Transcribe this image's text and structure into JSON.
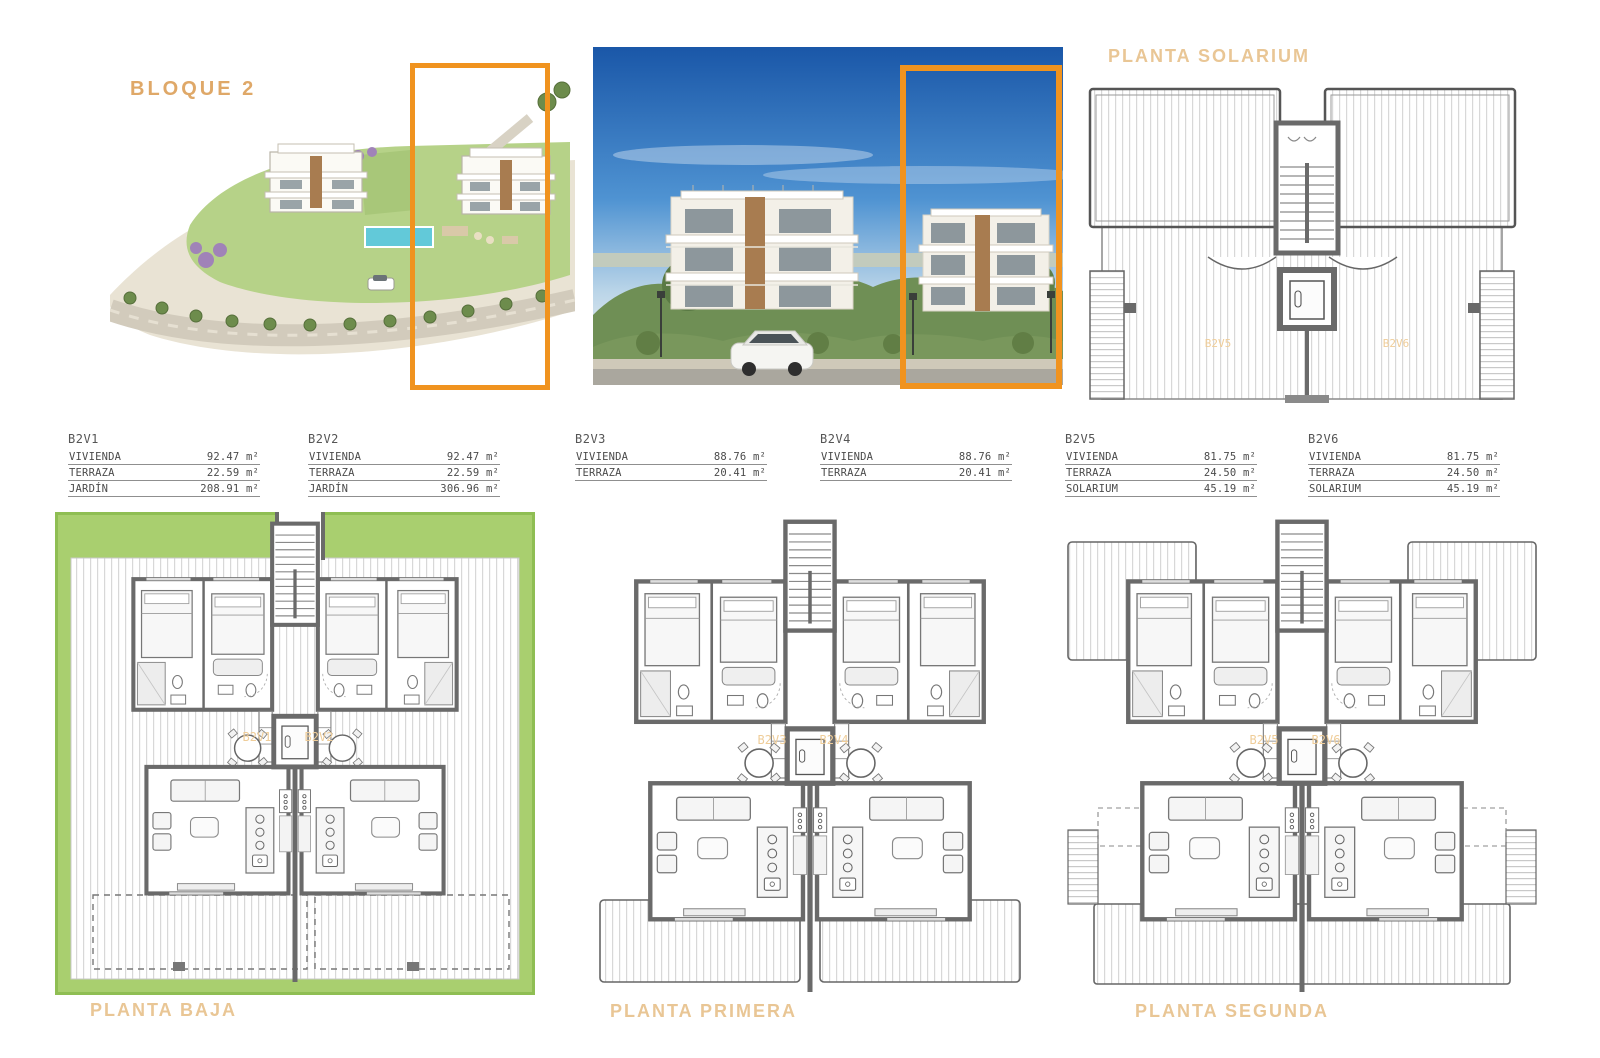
{
  "colors": {
    "accent_orange": "#F0931F",
    "label_tan": "#E9C695",
    "bloque_tan": "#DFA868",
    "garden_green": "#A9CF6F",
    "wall_gray": "#6A6A6A"
  },
  "header": {
    "bloque_label": "BLOQUE 2",
    "solarium_title": "PLANTA SOLARIUM"
  },
  "solarium_plan": {
    "unit_left": "B2V5",
    "unit_right": "B2V6"
  },
  "tables": [
    {
      "id": "B2V1",
      "rows": [
        {
          "label": "VIVIENDA",
          "value": "92.47 m²"
        },
        {
          "label": "TERRAZA",
          "value": "22.59 m²"
        },
        {
          "label": "JARDÍN",
          "value": "208.91 m²"
        }
      ]
    },
    {
      "id": "B2V2",
      "rows": [
        {
          "label": "VIVIENDA",
          "value": "92.47 m²"
        },
        {
          "label": "TERRAZA",
          "value": "22.59 m²"
        },
        {
          "label": "JARDÍN",
          "value": "306.96 m²"
        }
      ]
    },
    {
      "id": "B2V3",
      "rows": [
        {
          "label": "VIVIENDA",
          "value": "88.76 m²"
        },
        {
          "label": "TERRAZA",
          "value": "20.41 m²"
        }
      ]
    },
    {
      "id": "B2V4",
      "rows": [
        {
          "label": "VIVIENDA",
          "value": "88.76 m²"
        },
        {
          "label": "TERRAZA",
          "value": "20.41 m²"
        }
      ]
    },
    {
      "id": "B2V5",
      "rows": [
        {
          "label": "VIVIENDA",
          "value": "81.75 m²"
        },
        {
          "label": "TERRAZA",
          "value": "24.50 m²"
        },
        {
          "label": "SOLARIUM",
          "value": "45.19 m²"
        }
      ]
    },
    {
      "id": "B2V6",
      "rows": [
        {
          "label": "VIVIENDA",
          "value": "81.75 m²"
        },
        {
          "label": "TERRAZA",
          "value": "24.50 m²"
        },
        {
          "label": "SOLARIUM",
          "value": "45.19 m²"
        }
      ]
    }
  ],
  "floor_plans": [
    {
      "title": "PLANTA BAJA",
      "unit_left": "B2V1",
      "unit_right": "B2V2"
    },
    {
      "title": "PLANTA PRIMERA",
      "unit_left": "B2V3",
      "unit_right": "B2V4"
    },
    {
      "title": "PLANTA SEGUNDA",
      "unit_left": "B2V5",
      "unit_right": "B2V6"
    }
  ]
}
